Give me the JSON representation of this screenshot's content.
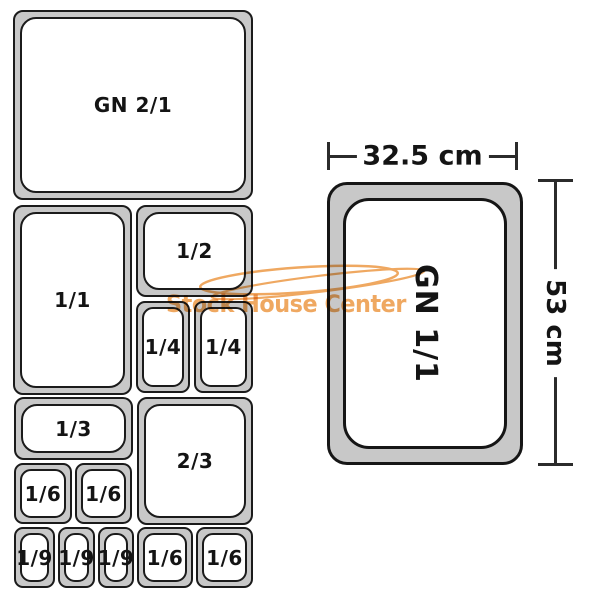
{
  "diagram_title": "Gastronorm pan size diagram",
  "left_grid": {
    "pans": [
      {
        "label": "GN 2/1",
        "x": 13,
        "y": 10,
        "w": 240,
        "h": 190
      },
      {
        "label": "1/1",
        "x": 13,
        "y": 205,
        "w": 119,
        "h": 190
      },
      {
        "label": "1/2",
        "x": 136,
        "y": 205,
        "w": 117,
        "h": 92
      },
      {
        "label": "1/4",
        "x": 136,
        "y": 301,
        "w": 54,
        "h": 92
      },
      {
        "label": "1/4",
        "x": 194,
        "y": 301,
        "w": 59,
        "h": 92
      },
      {
        "label": "1/3",
        "x": 14,
        "y": 397,
        "w": 119,
        "h": 63
      },
      {
        "label": "2/3",
        "x": 137,
        "y": 397,
        "w": 116,
        "h": 128
      },
      {
        "label": "1/6",
        "x": 14,
        "y": 463,
        "w": 58,
        "h": 61
      },
      {
        "label": "1/6",
        "x": 75,
        "y": 463,
        "w": 57,
        "h": 61
      },
      {
        "label": "1/9",
        "x": 14,
        "y": 527,
        "w": 41,
        "h": 61
      },
      {
        "label": "1/9",
        "x": 58,
        "y": 527,
        "w": 37,
        "h": 61
      },
      {
        "label": "1/9",
        "x": 98,
        "y": 527,
        "w": 36,
        "h": 61
      },
      {
        "label": "1/6",
        "x": 137,
        "y": 527,
        "w": 56,
        "h": 61
      },
      {
        "label": "1/6",
        "x": 196,
        "y": 527,
        "w": 57,
        "h": 61
      }
    ]
  },
  "right_diagram": {
    "pan_label": "GN 1/1",
    "width_label": "32.5 cm",
    "height_label": "53 cm"
  },
  "watermark": {
    "text": "Stock House Center",
    "color": "#efa861"
  },
  "colors": {
    "pan_fill": "#c8c8c8",
    "outline": "#1b1b1b",
    "dimension_line": "#2b2b2b",
    "label_text": "#141414",
    "watermark": "#efa861"
  }
}
